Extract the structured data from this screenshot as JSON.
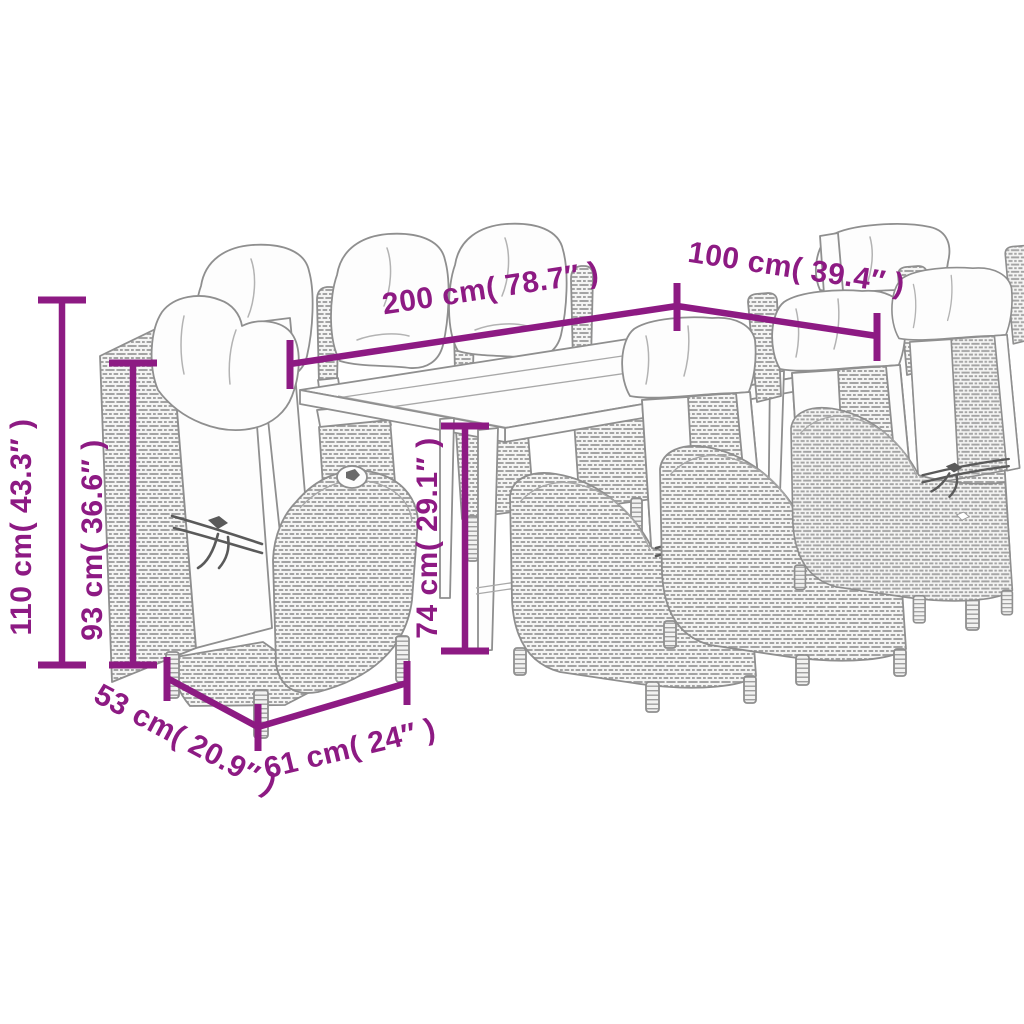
{
  "diagram": {
    "type": "furniture-dimension-diagram",
    "scene": "9-piece outdoor dining set: long rectangular table with eight reclining poly-rattan chairs with cushions",
    "colors": {
      "dimension": "#8D1A83",
      "line_art": "#8F8F8F"
    },
    "labels": {
      "table_length": "200 cm( 78.7″ )",
      "table_width": "100 cm( 39.4″ )",
      "chair_height": "110 cm( 43.3″ )",
      "backrest_height": "93 cm( 36.6″ )",
      "table_height": "74 cm( 29.1″ )",
      "seat_depth": "53 cm( 20.9″ )",
      "seat_width": "61 cm( 24″ )"
    }
  }
}
